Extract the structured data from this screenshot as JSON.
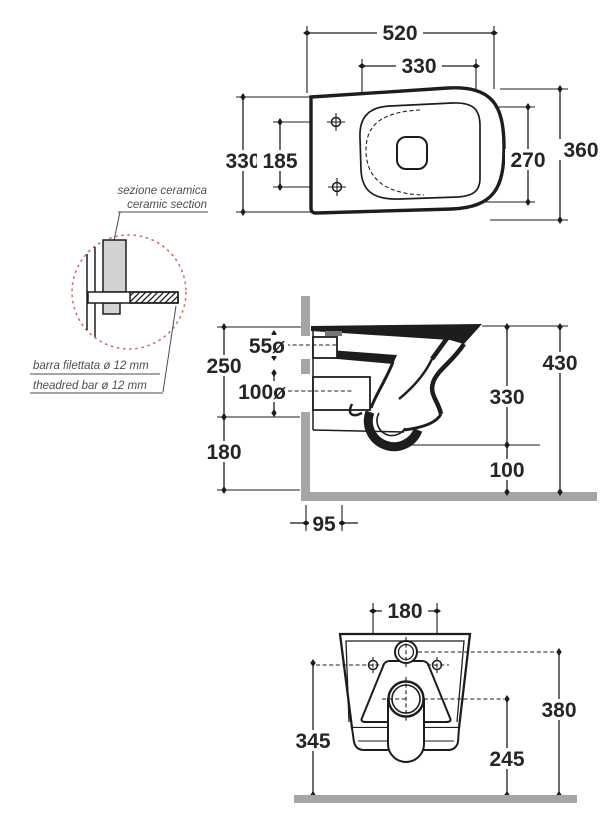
{
  "plan": {
    "width": "520",
    "seat_width": "330",
    "depth": "330",
    "hole_spacing": "185",
    "total_depth": "360",
    "bowl_depth": "270"
  },
  "side": {
    "inlet": "55ø",
    "upper": "250",
    "outlet": "100ø",
    "lower": "180",
    "total_height": "430",
    "body_height": "330",
    "trap_height": "100",
    "floor_offset": "95"
  },
  "rear": {
    "hole_spacing": "180",
    "hole_height": "345",
    "outlet_height": "245",
    "inlet_height": "380"
  },
  "callout": {
    "line1_it": "sezione ceramica",
    "line1_en": "ceramic section",
    "line2_it": "barra filettata ø 12 mm",
    "line2_en": "theadred bar ø 12 mm"
  },
  "colors": {
    "line": "#1d1d1b",
    "wall_gray": "#a5a5a5",
    "ceramic_gray": "#d2d2d2",
    "detail_red": "#d4655f"
  }
}
